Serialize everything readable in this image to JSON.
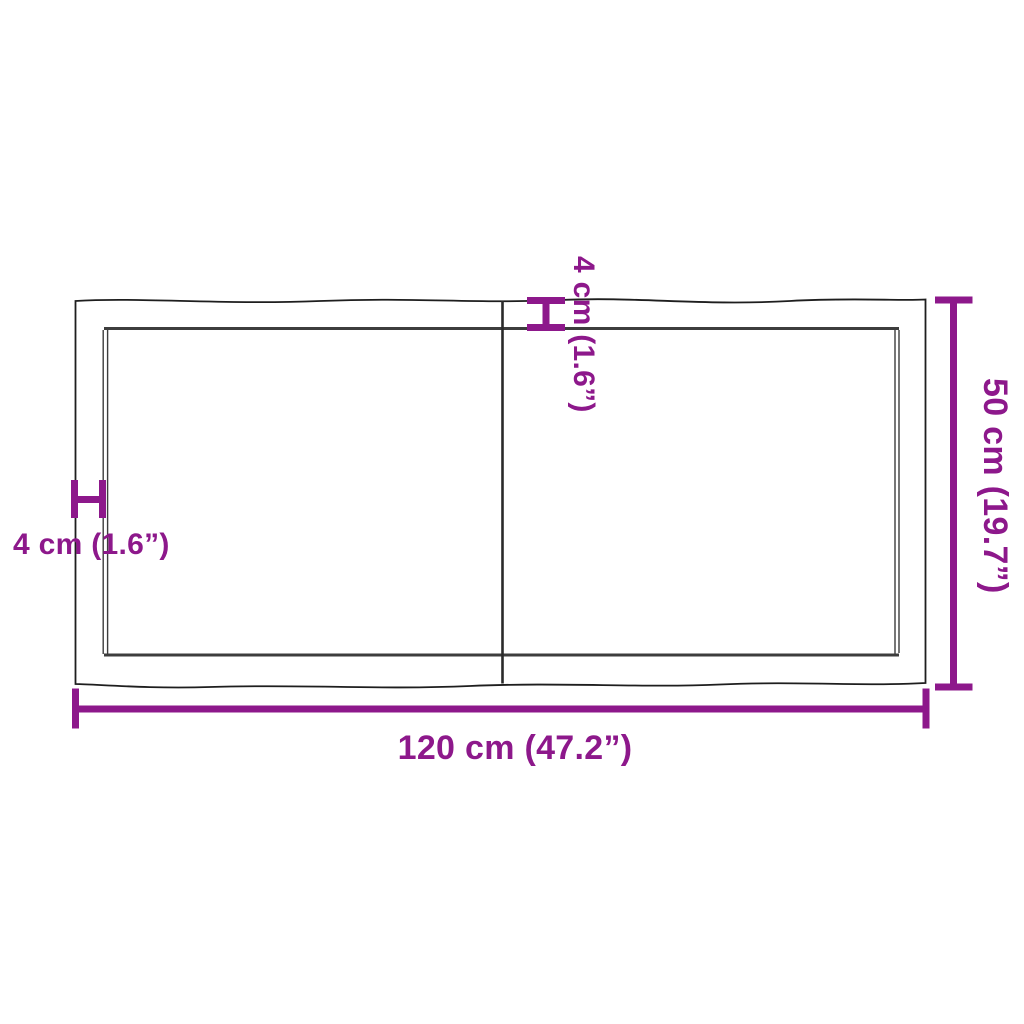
{
  "colors": {
    "accent": "#8D188B",
    "outline": "#1e1e1e",
    "inner_outline": "#3d3d3d",
    "seam": "#2a2a2a",
    "background": "#ffffff"
  },
  "dimensions": {
    "width_label": "120 cm (47.2”)",
    "height_label": "50 cm (19.7”)",
    "thickness_left_label": "4 cm (1.6”)",
    "thickness_top_label": "4 cm (1.6”)",
    "width_cm": 120,
    "width_in": 47.2,
    "height_cm": 50,
    "height_in": 19.7,
    "thickness_cm": 4,
    "thickness_in": 1.6
  }
}
